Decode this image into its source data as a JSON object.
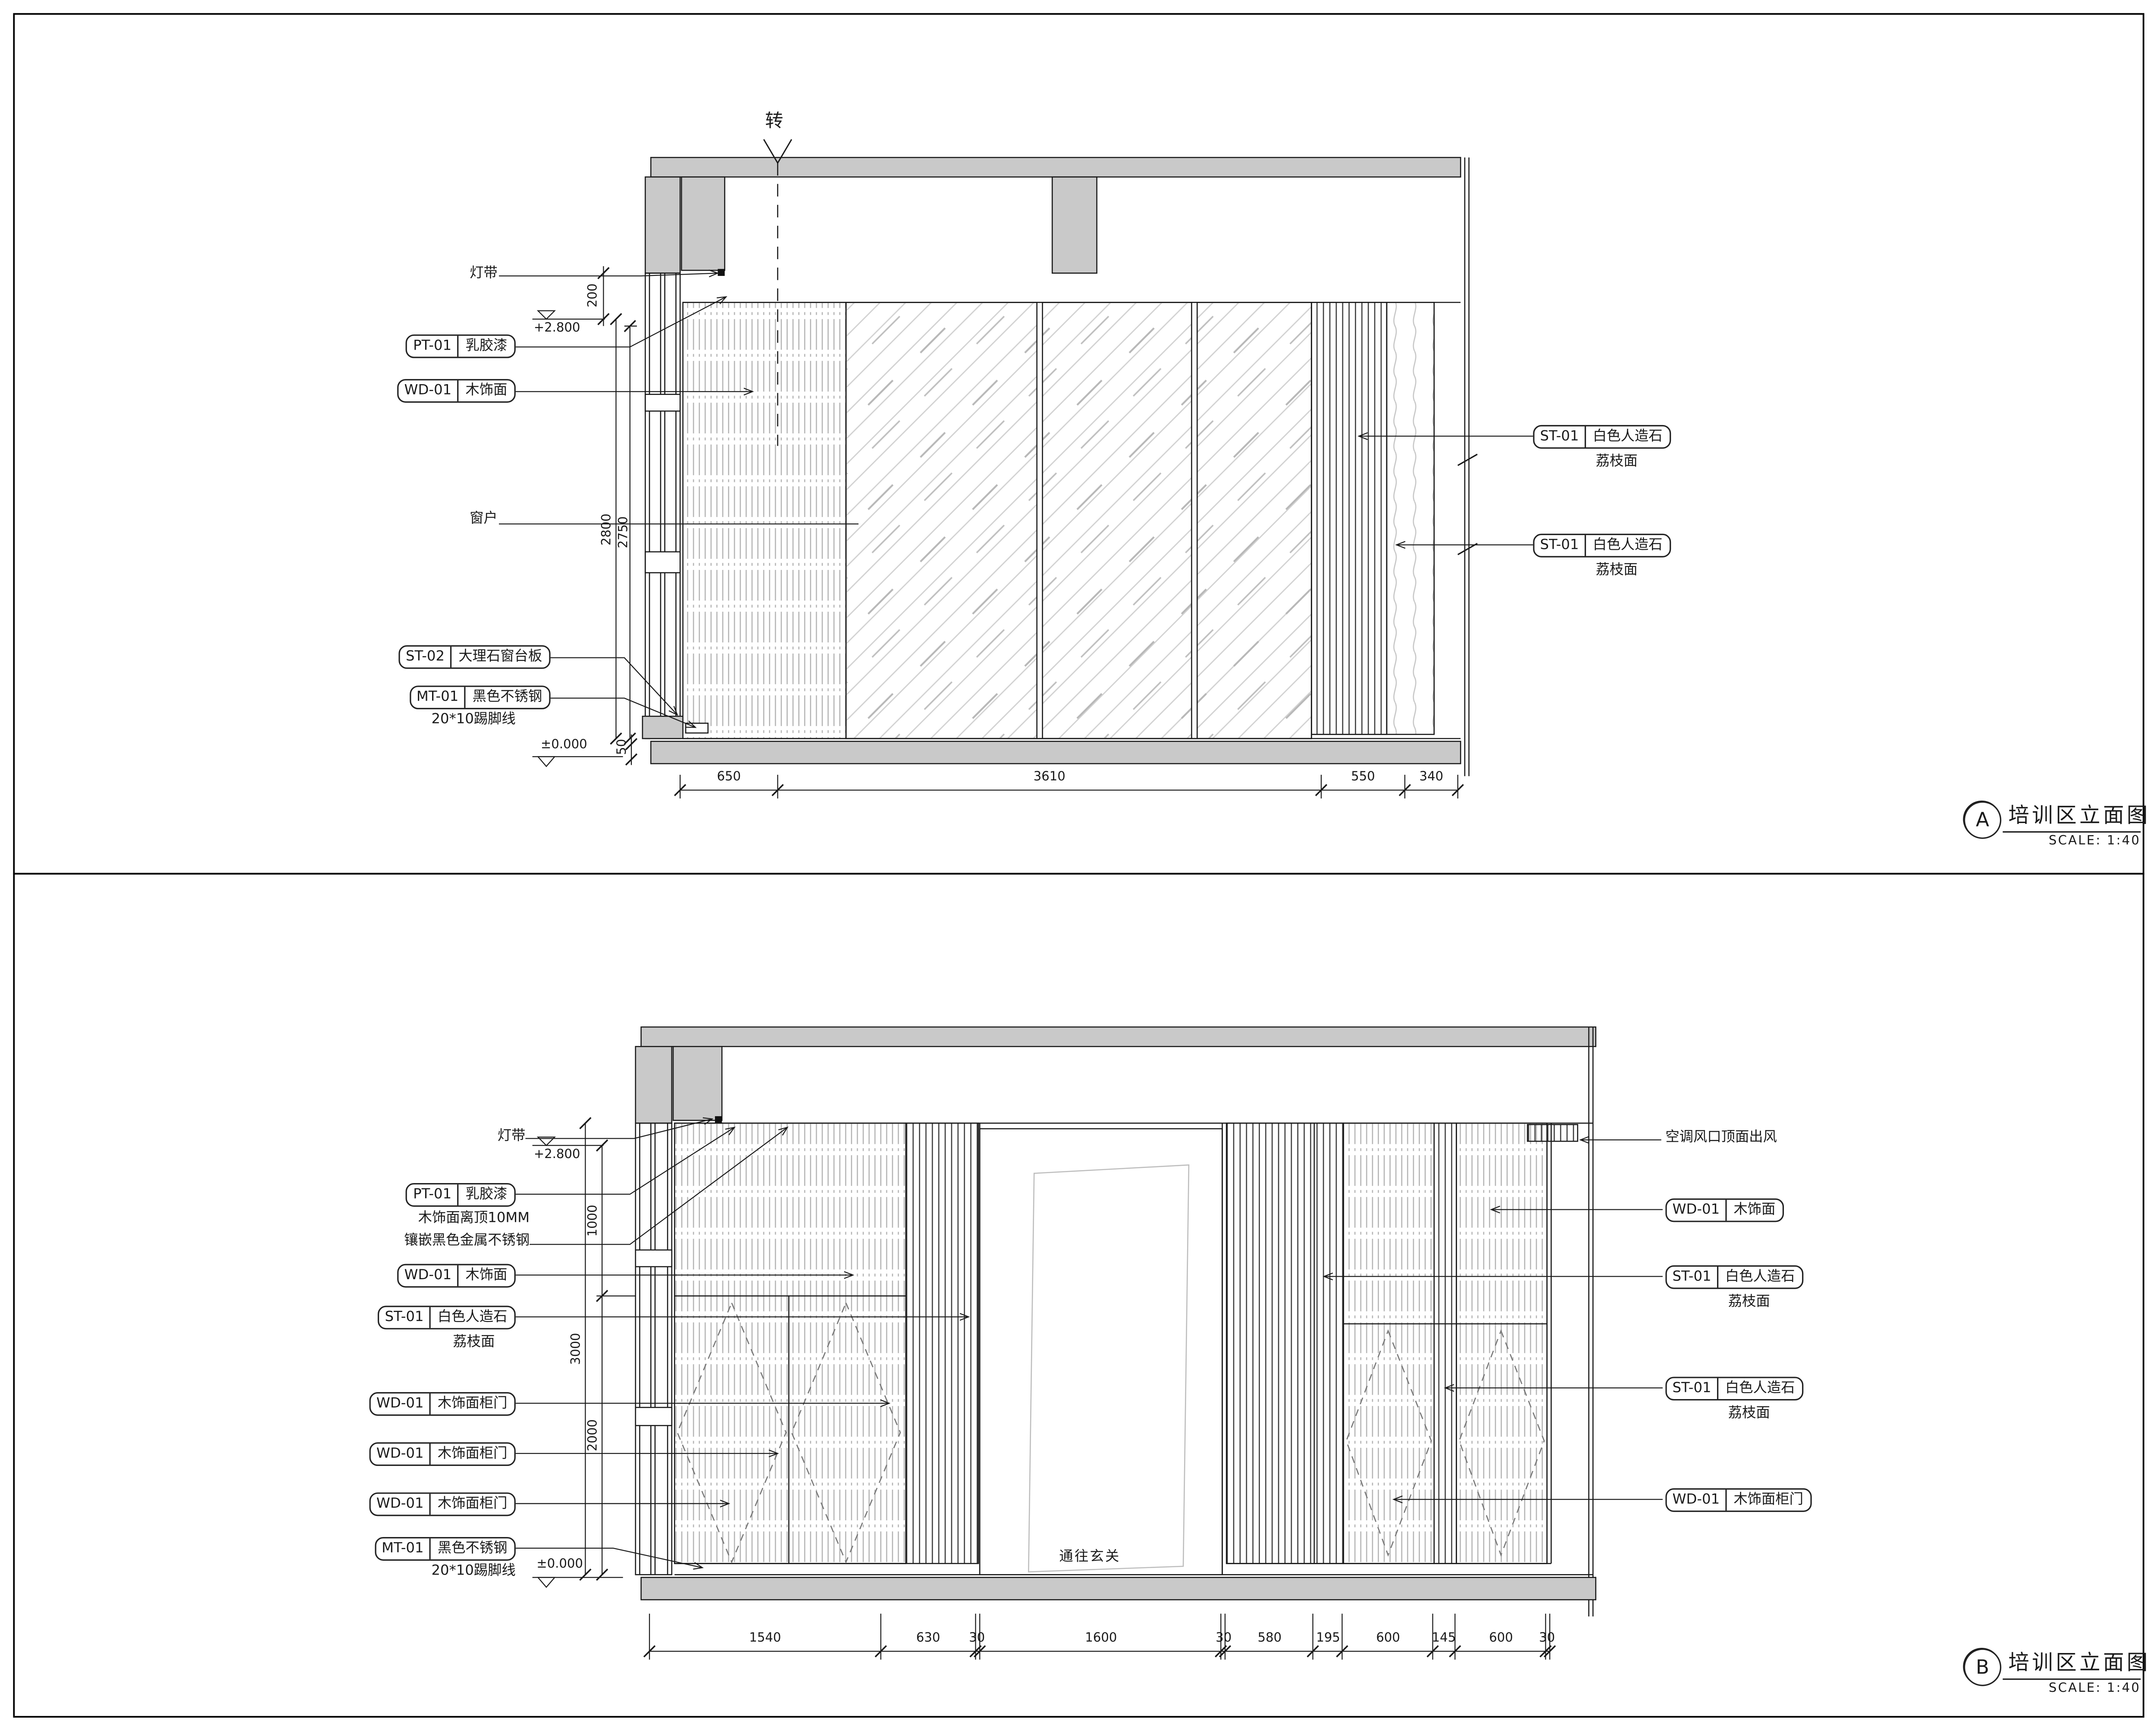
{
  "drawing": {
    "panel_a": {
      "tag": "A",
      "title": "培训区立面图",
      "scale_label": "SCALE: 1:40",
      "fold_marker": "转",
      "levels": {
        "ceiling": "+2.800",
        "floor": "±0.000"
      },
      "dims": {
        "left_vertical": [
          "200",
          "2800",
          "2750",
          "50"
        ],
        "bottom": [
          "650",
          "3610",
          "550",
          "340"
        ]
      },
      "labels_left": [
        {
          "text": "灯带"
        },
        {
          "tag": "PT-01",
          "text": "乳胶漆"
        },
        {
          "tag": "WD-01",
          "text": "木饰面"
        },
        {
          "text": "窗户"
        },
        {
          "tag": "ST-02",
          "text": "大理石窗台板"
        },
        {
          "tag": "MT-01",
          "text": "黑色不锈钢",
          "note": "20*10踢脚线"
        }
      ],
      "labels_right": [
        {
          "tag": "ST-01",
          "text": "白色人造石",
          "note": "荔枝面"
        },
        {
          "tag": "ST-01",
          "text": "白色人造石",
          "note": "荔枝面"
        }
      ]
    },
    "panel_b": {
      "tag": "B",
      "title": "培训区立面图",
      "scale_label": "SCALE: 1:40",
      "door_label": "通往玄关",
      "levels": {
        "ceiling": "+2.800",
        "floor": "±0.000"
      },
      "dims": {
        "left_vertical": [
          "1000",
          "3000",
          "2000"
        ],
        "bottom": [
          "1540",
          "630",
          "30",
          "1600",
          "30",
          "580",
          "195",
          "600",
          "145",
          "600",
          "30"
        ]
      },
      "labels_left": [
        {
          "text": "灯带"
        },
        {
          "tag": "PT-01",
          "text": "乳胶漆"
        },
        {
          "text": "木饰面离顶10MM"
        },
        {
          "text": "镶嵌黑色金属不锈钢"
        },
        {
          "tag": "WD-01",
          "text": "木饰面"
        },
        {
          "tag": "ST-01",
          "text": "白色人造石",
          "note": "荔枝面"
        },
        {
          "tag": "WD-01",
          "text": "木饰面柜门"
        },
        {
          "tag": "WD-01",
          "text": "木饰面柜门"
        },
        {
          "tag": "WD-01",
          "text": "木饰面柜门"
        },
        {
          "tag": "MT-01",
          "text": "黑色不锈钢",
          "note": "20*10踢脚线"
        }
      ],
      "labels_right": [
        {
          "text": "空调风口顶面出风"
        },
        {
          "tag": "WD-01",
          "text": "木饰面"
        },
        {
          "tag": "ST-01",
          "text": "白色人造石",
          "note": "荔枝面"
        },
        {
          "tag": "ST-01",
          "text": "白色人造石",
          "note": "荔枝面"
        },
        {
          "tag": "WD-01",
          "text": "木饰面柜门"
        }
      ]
    },
    "colors": {
      "line": "#1a1a1a",
      "concrete_fill": "#c9c9c9"
    }
  }
}
